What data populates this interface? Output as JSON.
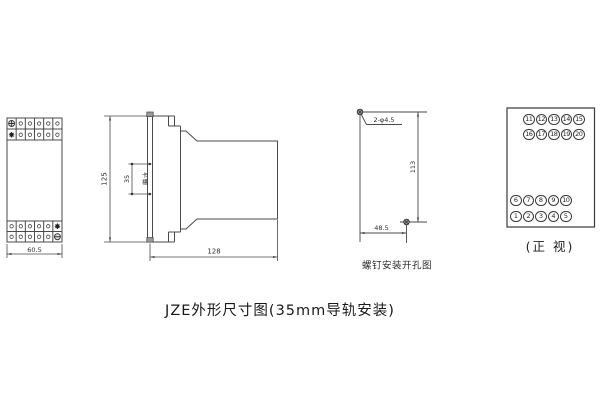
{
  "title": "JZE外形尺寸图(35mm导轨安装)",
  "colors": {
    "ink": "#4a4a4a",
    "text": "#2a2a2a",
    "background": "#ffffff"
  },
  "front_view": {
    "width_dim": "60.5"
  },
  "side_view": {
    "height_dim": "125",
    "slot_dim": "35",
    "slot_label": "卡槽",
    "depth_dim": "128"
  },
  "drill_view": {
    "holes_label": "2-φ4.5",
    "vertical_dim": "113",
    "horizontal_dim": "48.5",
    "caption": "螺钉安装开孔图"
  },
  "terminal_view": {
    "caption": "(正 视)",
    "rows": {
      "top1": [
        "11",
        "12",
        "13",
        "14",
        "15"
      ],
      "top2": [
        "16",
        "17",
        "18",
        "19",
        "20"
      ],
      "bottom1": [
        "6",
        "7",
        "8",
        "9",
        "10"
      ],
      "bottom2": [
        "1",
        "2",
        "3",
        "4",
        "5"
      ]
    }
  }
}
